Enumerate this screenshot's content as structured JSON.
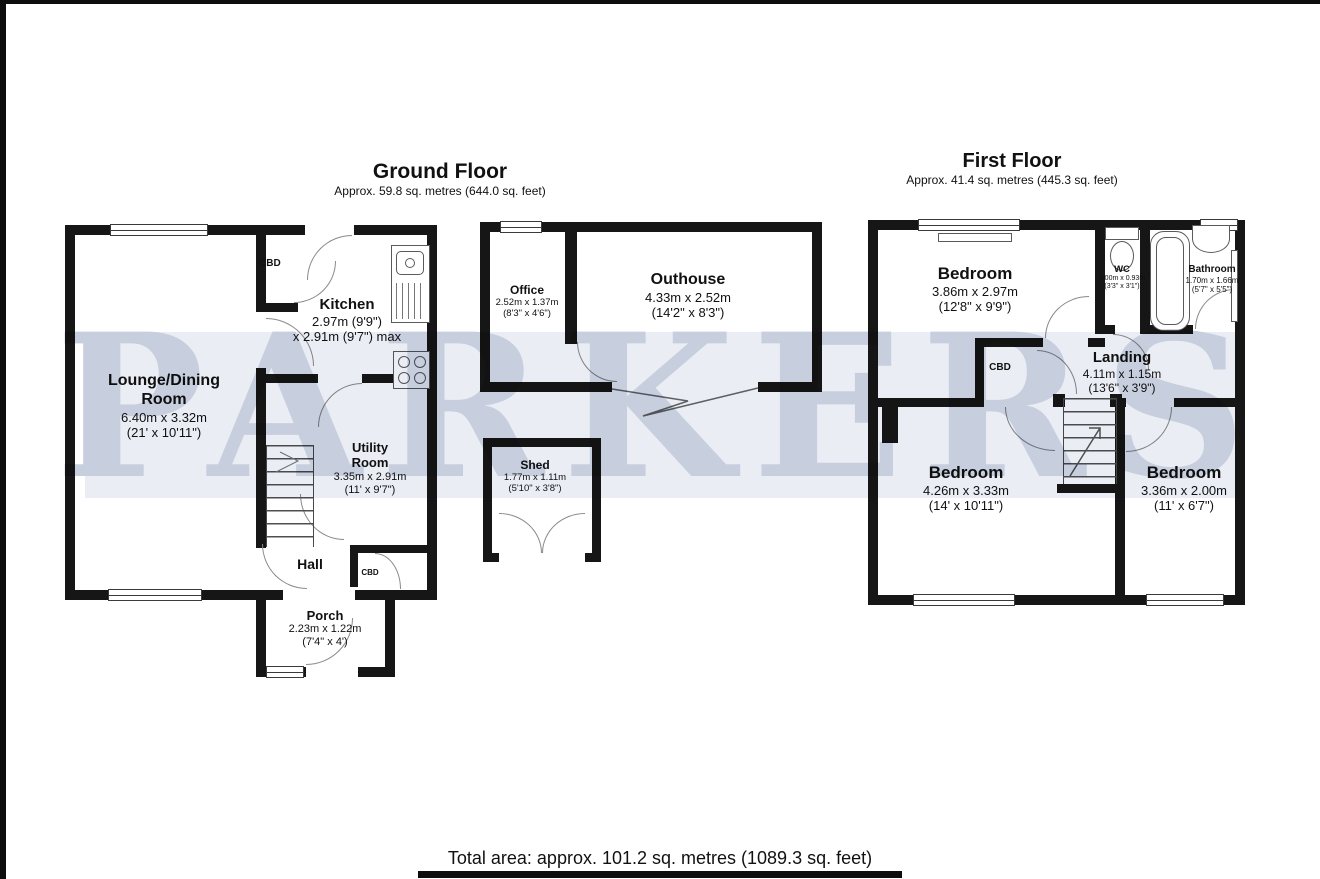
{
  "page": {
    "watermark": "PARKERS",
    "footer_total": "Total area: approx. 101.2 sq. metres (1089.3 sq. feet)"
  },
  "ground_floor": {
    "title": "Ground Floor",
    "subtitle": "Approx. 59.8 sq. metres (644.0 sq. feet)",
    "lounge": {
      "name1": "Lounge/Dining",
      "name2": "Room",
      "metric": "6.40m x 3.32m",
      "imperial": "(21' x 10'11\")"
    },
    "kitchen": {
      "name": "Kitchen",
      "metric": "2.97m (9'9\")",
      "metric2": "x 2.91m (9'7\") max"
    },
    "utility": {
      "name1": "Utility",
      "name2": "Room",
      "metric": "3.35m x 2.91m",
      "imperial": "(11' x 9'7\")"
    },
    "hall": {
      "name": "Hall"
    },
    "porch": {
      "name": "Porch",
      "metric": "2.23m x 1.22m",
      "imperial": "(7'4\" x 4')"
    },
    "office": {
      "name": "Office",
      "metric": "2.52m x 1.37m",
      "imperial": "(8'3\" x 4'6\")"
    },
    "outhouse": {
      "name": "Outhouse",
      "metric": "4.33m x 2.52m",
      "imperial": "(14'2\" x 8'3\")"
    },
    "shed": {
      "name": "Shed",
      "metric": "1.77m x 1.11m",
      "imperial": "(5'10\" x 3'8\")"
    },
    "cbd_kitchen": "CBD",
    "cbd_hall": "CBD"
  },
  "first_floor": {
    "title": "First Floor",
    "subtitle": "Approx. 41.4 sq. metres (445.3 sq. feet)",
    "bedroom1": {
      "name": "Bedroom",
      "metric": "3.86m x 2.97m",
      "imperial": "(12'8\" x 9'9\")"
    },
    "bedroom2": {
      "name": "Bedroom",
      "metric": "4.26m x 3.33m",
      "imperial": "(14' x 10'11\")"
    },
    "bedroom3": {
      "name": "Bedroom",
      "metric": "3.36m x 2.00m",
      "imperial": "(11' x 6'7\")"
    },
    "wc": {
      "name": "WC",
      "metric": "1.00m x 0.93m",
      "imperial": "(3'3\" x 3'1\")"
    },
    "bathroom": {
      "name": "Bathroom",
      "metric": "1.70m x 1.66m",
      "imperial": "(5'7\" x 5'5\")"
    },
    "landing": {
      "name": "Landing",
      "metric": "4.11m x 1.15m",
      "imperial": "(13'6\" x 3'9\")"
    },
    "cbd_landing": "CBD"
  },
  "colors": {
    "wall": "#161616",
    "watermark_text": "#c7cedd",
    "watermark_band": "#eaedf4"
  }
}
